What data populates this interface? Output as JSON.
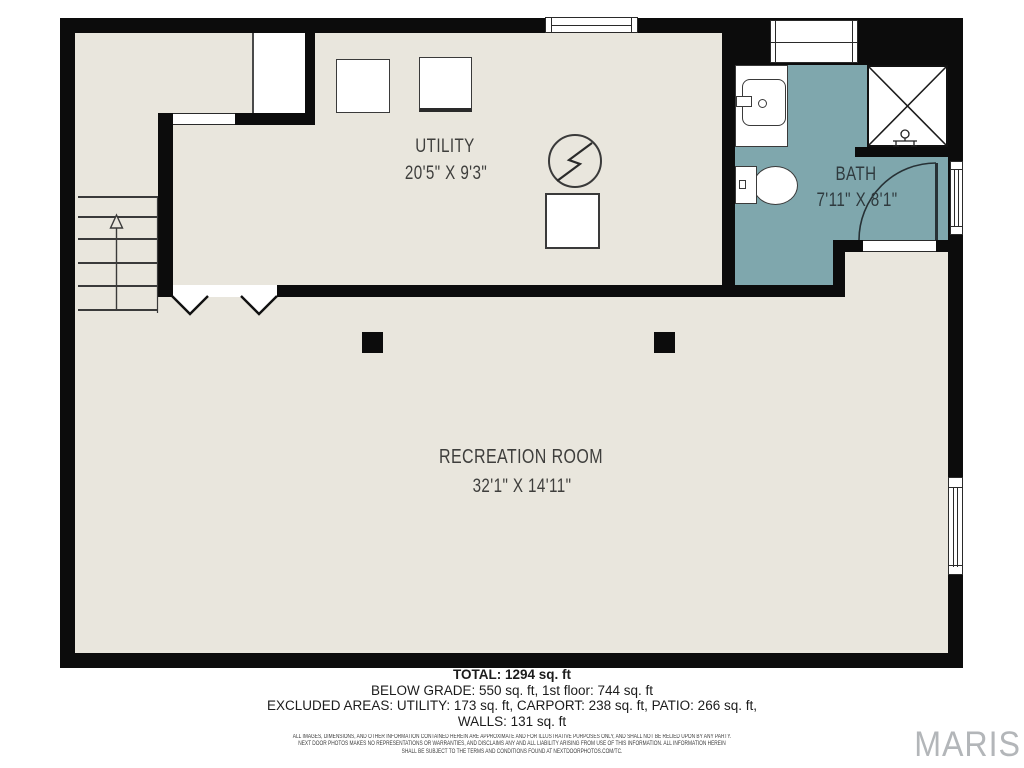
{
  "plan": {
    "rooms": [
      {
        "label": "UTILITY",
        "dims": "20'5\" X 9'3\""
      },
      {
        "label": "BATH",
        "dims": "7'11\" X 8'1\""
      },
      {
        "label": "RECREATION ROOM",
        "dims": "32'1\" X 14'11\""
      }
    ]
  },
  "summary": {
    "total": "TOTAL: 1294 sq. ft",
    "below_grade": "BELOW GRADE: 550 sq. ft, 1st floor: 744 sq. ft",
    "excluded": "EXCLUDED AREAS: UTILITY: 173 sq. ft, CARPORT: 238 sq. ft, PATIO: 266 sq. ft,",
    "walls": "WALLS: 131 sq. ft"
  },
  "disclaimer": {
    "line1": "ALL IMAGES, DIMENSIONS, AND OTHER INFORMATION CONTAINED HEREIN ARE APPROXIMATE AND FOR ILLUSTRATIVE PURPOSES ONLY, AND SHALL NOT BE RELIED UPON BY ANY PARTY.",
    "line2": "NEXT DOOR PHOTOS MAKES NO REPRESENTATIONS OR WARRANTIES, AND DISCLAIMS ANY AND ALL LIABILITY ARISING FROM USE OF THIS INFORMATION. ALL INFORMATION HEREIN",
    "line3": "SHALL BE SUBJECT TO THE TERMS AND CONDITIONS FOUND AT NEXTDOORPHOTOS.COM/TC."
  },
  "branding": {
    "logo": "MARIS"
  },
  "colors": {
    "beige": "#e9e6dd",
    "teal": "#7fa7ad",
    "wall": "#0c0c0c",
    "label": "#3e3e3c"
  }
}
